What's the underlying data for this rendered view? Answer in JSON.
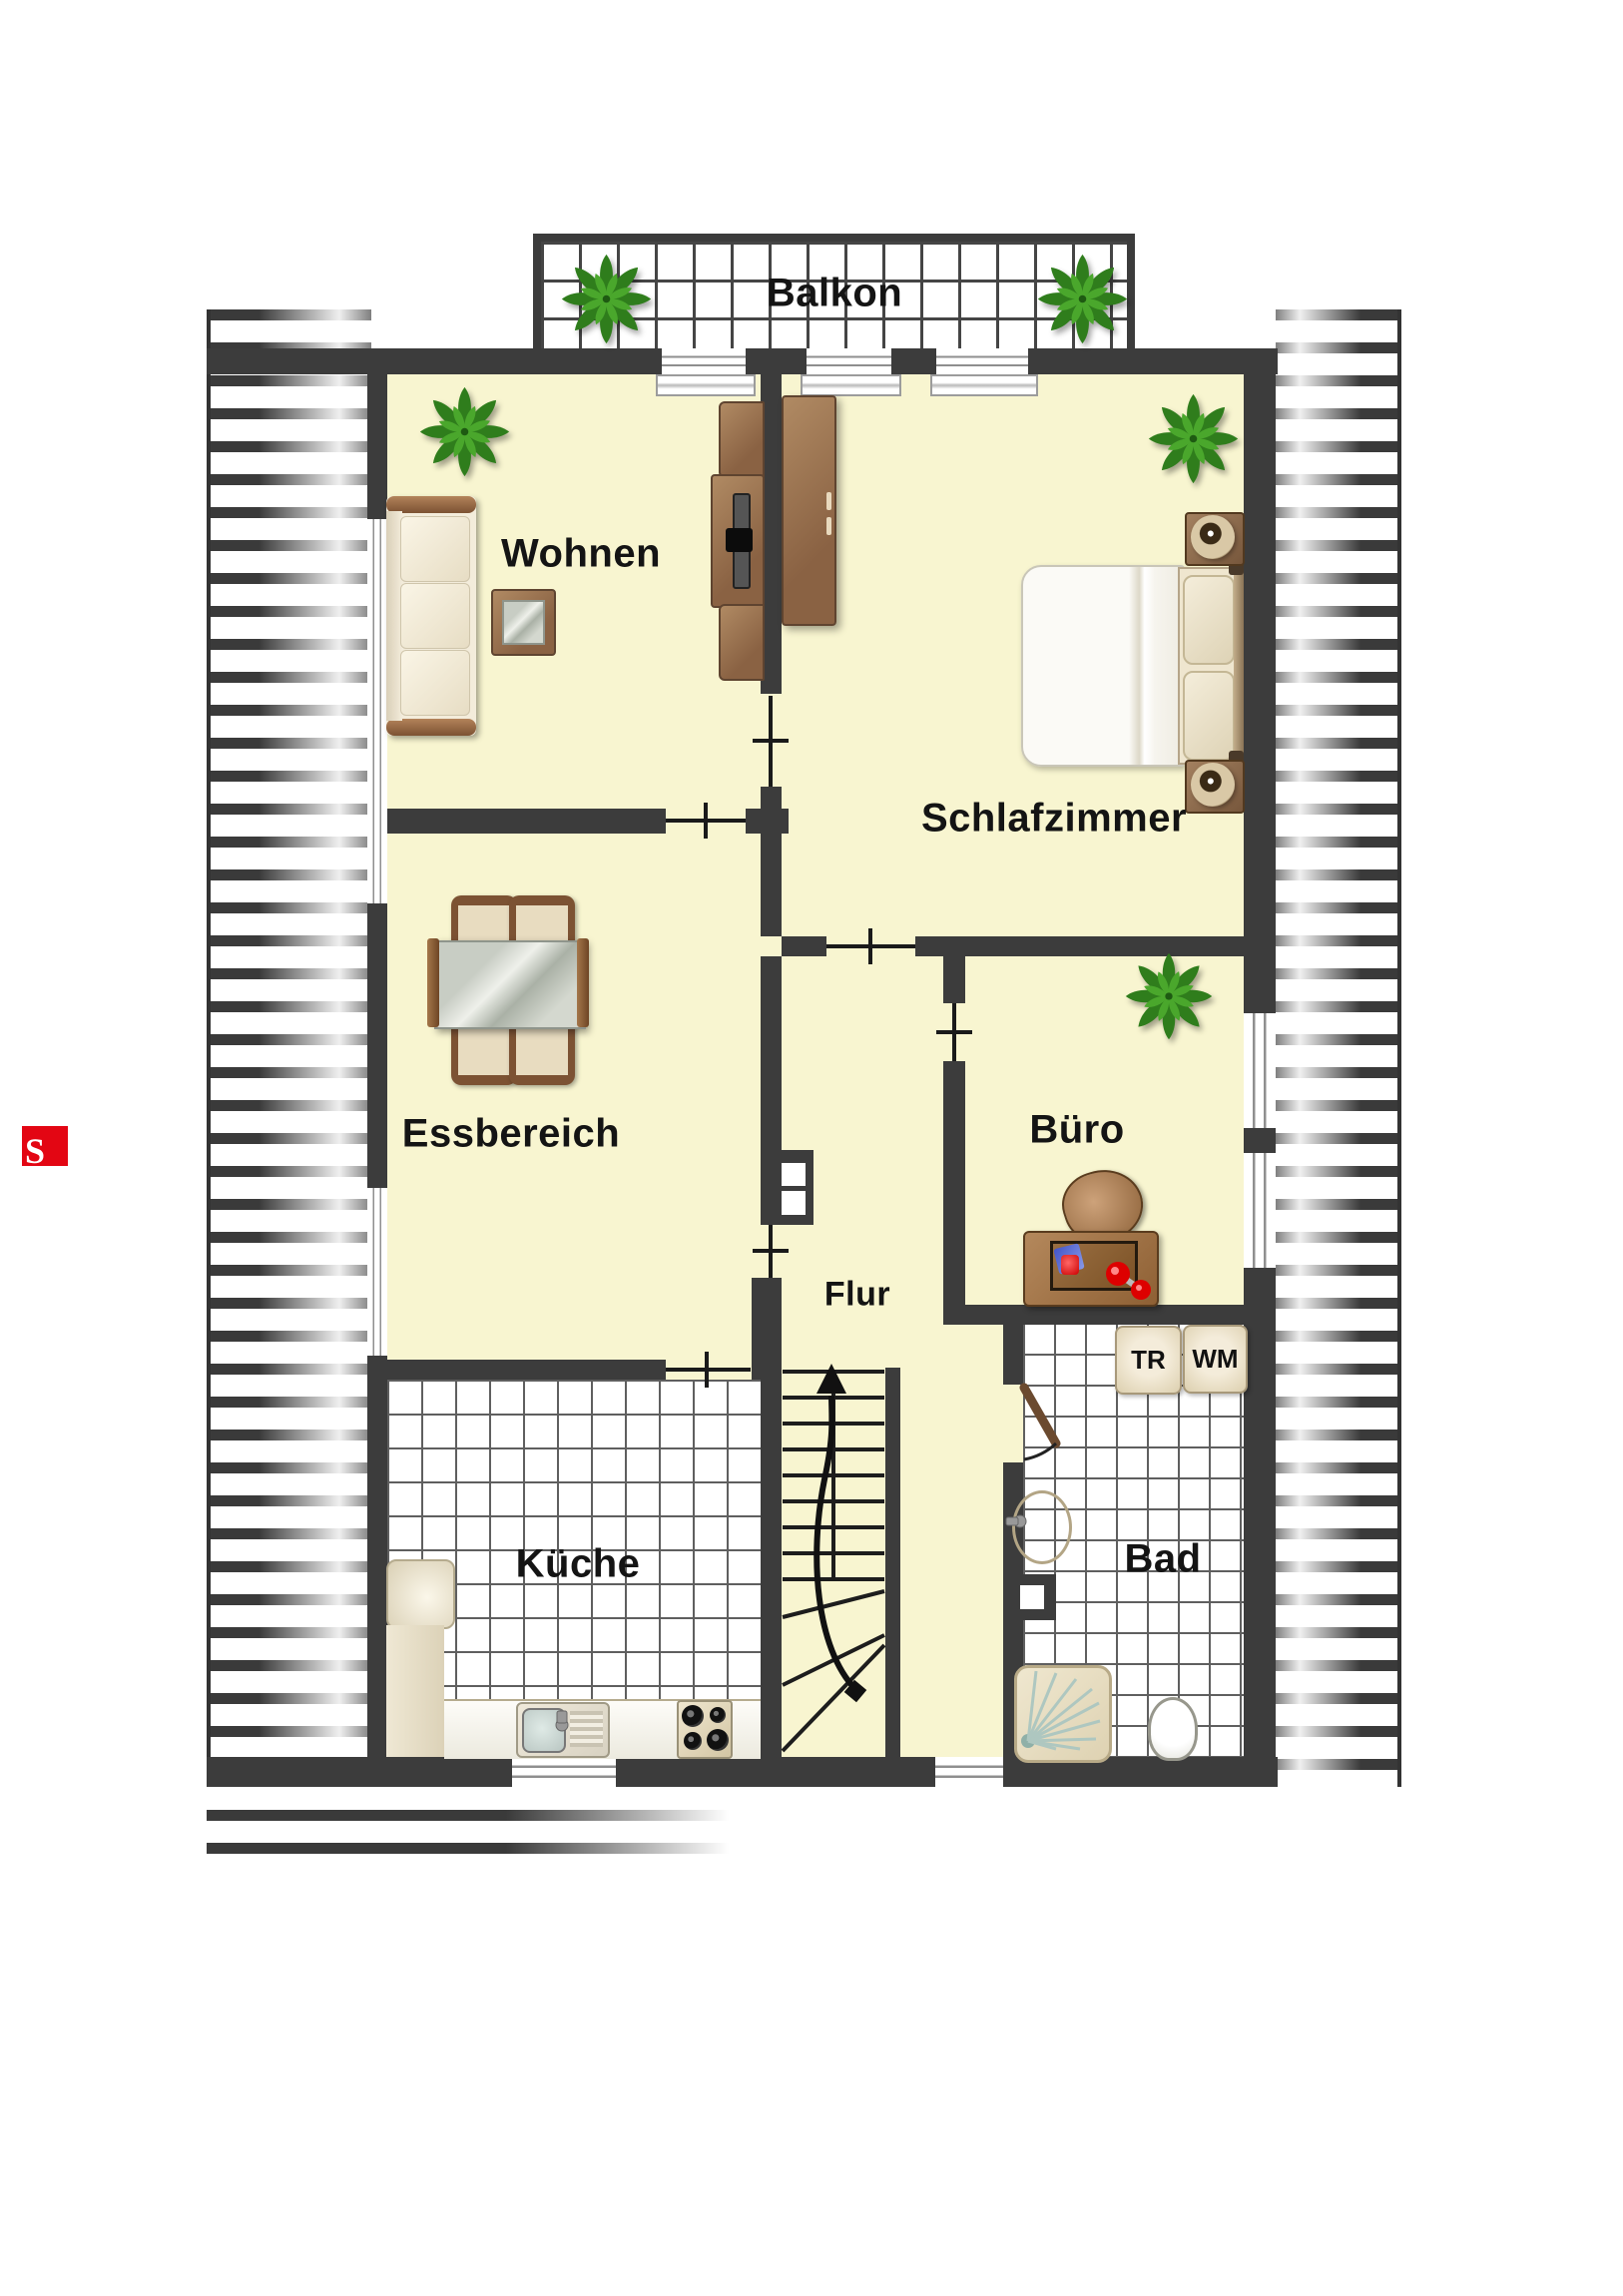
{
  "title": "Dachgeschoss Wohnung Grundriss",
  "labels": {
    "balcony": "Balkon",
    "living": "Wohnen",
    "bedroom": "Schlafzimmer",
    "dining": "Essbereich",
    "office": "Büro",
    "hall": "Flur",
    "kitchen": "Küche",
    "bath": "Bad",
    "dryer": "TR",
    "washer": "WM",
    "logo_letter": "S"
  },
  "colors": {
    "wall": "#3c3c3c",
    "room_fill": "#f8f5d0",
    "tile_line": "#5f5f5f",
    "accent_red": "#e30613",
    "wood_dark": "#5f4430",
    "wood_mid": "#9b7b5b",
    "plant_green": "#2f7d1c"
  },
  "icons": [
    "plant-icon",
    "sofa-icon",
    "tv-cabinet-icon",
    "side-table-icon",
    "wardrobe-icon",
    "double-bed-icon",
    "nightstand-lamp-icon",
    "dining-table-icon",
    "chair-icon",
    "desk-icon",
    "office-chair-icon",
    "stairs-up-icon",
    "chimney-shaft-icon",
    "kitchen-sink-icon",
    "stove-icon",
    "bath-sink-icon",
    "shower-icon",
    "toilet-icon",
    "door-swing-icon",
    "window-icon"
  ]
}
